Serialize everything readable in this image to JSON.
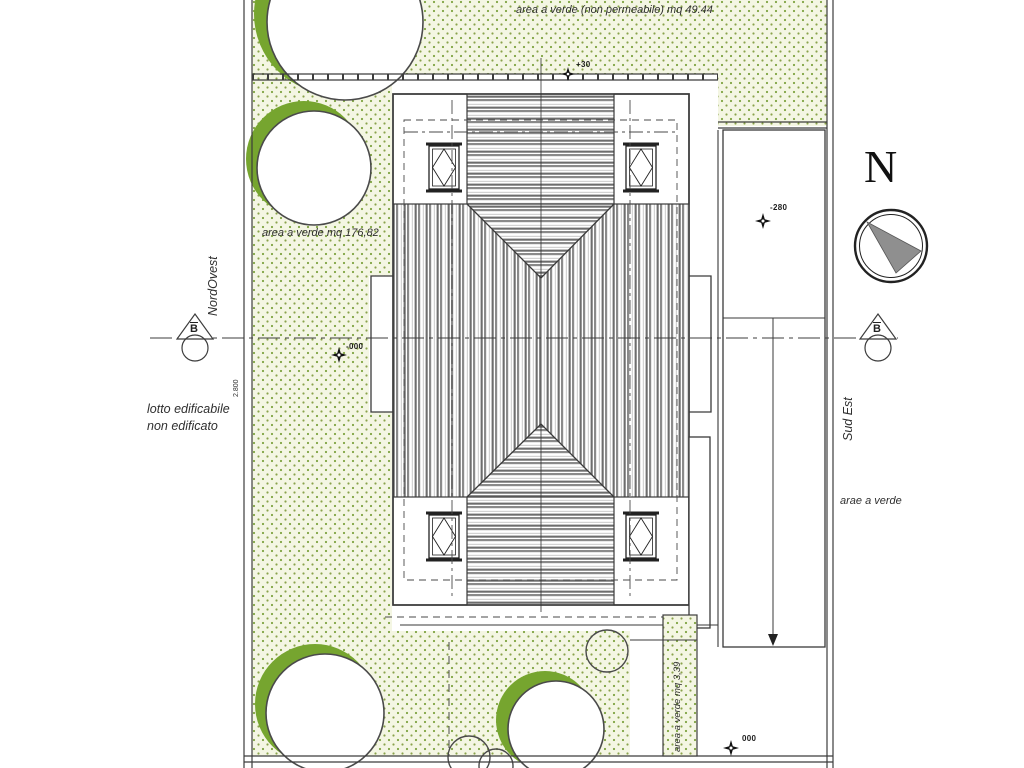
{
  "drawing": {
    "type": "architectural site plan - roof plan with garden",
    "green_labels": {
      "top": "area a verde  (non permeabile) mq 49.44",
      "left": "area a verde  mq 176,82",
      "strip": "area a verde  mq 3,39",
      "right": "arae a verde"
    },
    "orientation": {
      "northwest": "NordOvest",
      "southeast": "Sud Est",
      "north_letter": "N"
    },
    "lot_note": {
      "line1": "lotto edificabile",
      "line2": "non edificato"
    },
    "section_marker": "B",
    "elevations": {
      "roof_top": "+30",
      "ramp": "-280",
      "ground_left": "-000",
      "ground_bottom": "000",
      "boundary_dim": "2.800"
    },
    "colors": {
      "tree_green": "#76a52f",
      "stipple_dot": "#7fa341",
      "stipple_bg": "#f4f6e3",
      "compass_needle": "#8f8f8f",
      "line": "#3c3c3c"
    }
  }
}
